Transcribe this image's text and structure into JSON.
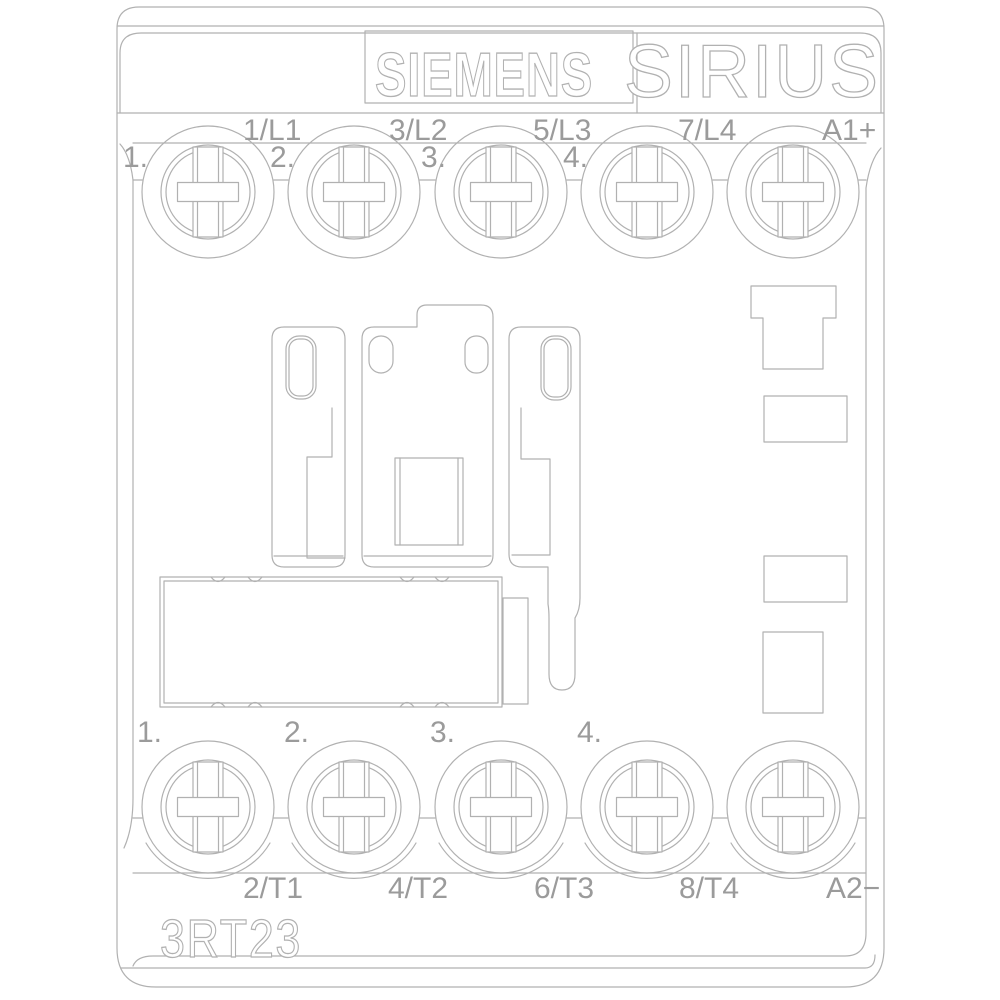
{
  "brand": "SIEMENS",
  "series": "SIRIUS",
  "model": "3RT23",
  "top_row": {
    "numbers": [
      "1.",
      "2.",
      "3.",
      "4."
    ],
    "terminals": [
      "1/L1",
      "3/L2",
      "5/L3",
      "7/L4",
      "A1+"
    ]
  },
  "bottom_row": {
    "numbers": [
      "1.",
      "2.",
      "3.",
      "4."
    ],
    "terminals": [
      "2/T1",
      "4/T2",
      "6/T3",
      "8/T4",
      "A2−"
    ]
  },
  "colors": {
    "background": "#ffffff",
    "line": "#b1b1b1",
    "text": "#9b9b9b"
  }
}
